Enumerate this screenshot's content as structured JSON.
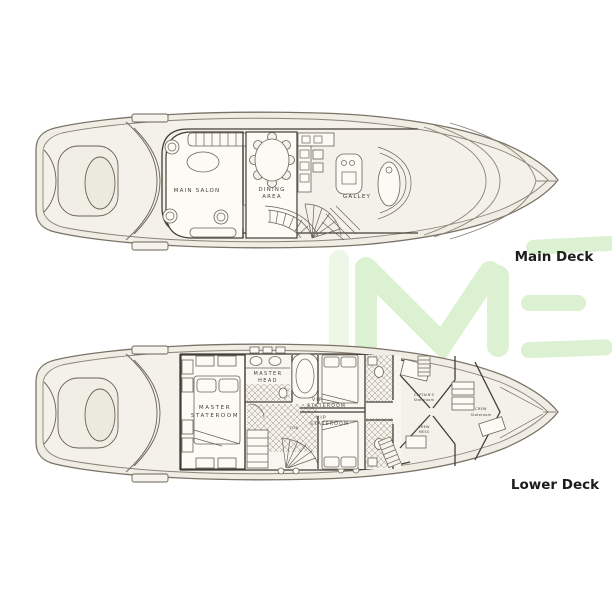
{
  "page": {
    "background": "#ffffff"
  },
  "watermark": {
    "text": "IME",
    "color": "#dcf1d1",
    "color_faint": "#edf6e7"
  },
  "main_deck": {
    "caption": "Main Deck",
    "labels": {
      "salon": "MAIN SALON",
      "dining_1": "DINING",
      "dining_2": "AREA",
      "galley": "GALLEY"
    }
  },
  "lower_deck": {
    "caption": "Lower Deck",
    "labels": {
      "master_1": "MASTER",
      "master_2": "STATEROOM",
      "head_1": "MASTER",
      "head_2": "HEAD",
      "vip_fwd_1": "VIP",
      "vip_fwd_2": "STATEROOM",
      "vip_aft_1": "VIP",
      "vip_aft_2": "STATEROOM",
      "tub": "TUB",
      "captain_1": "CAPTAIN'S",
      "captain_2": "Stateroom",
      "crew_mess_1": "CREW",
      "crew_mess_2": "MESS",
      "crew_cabin_1": "CREW",
      "crew_cabin_2": "Stateroom"
    }
  }
}
